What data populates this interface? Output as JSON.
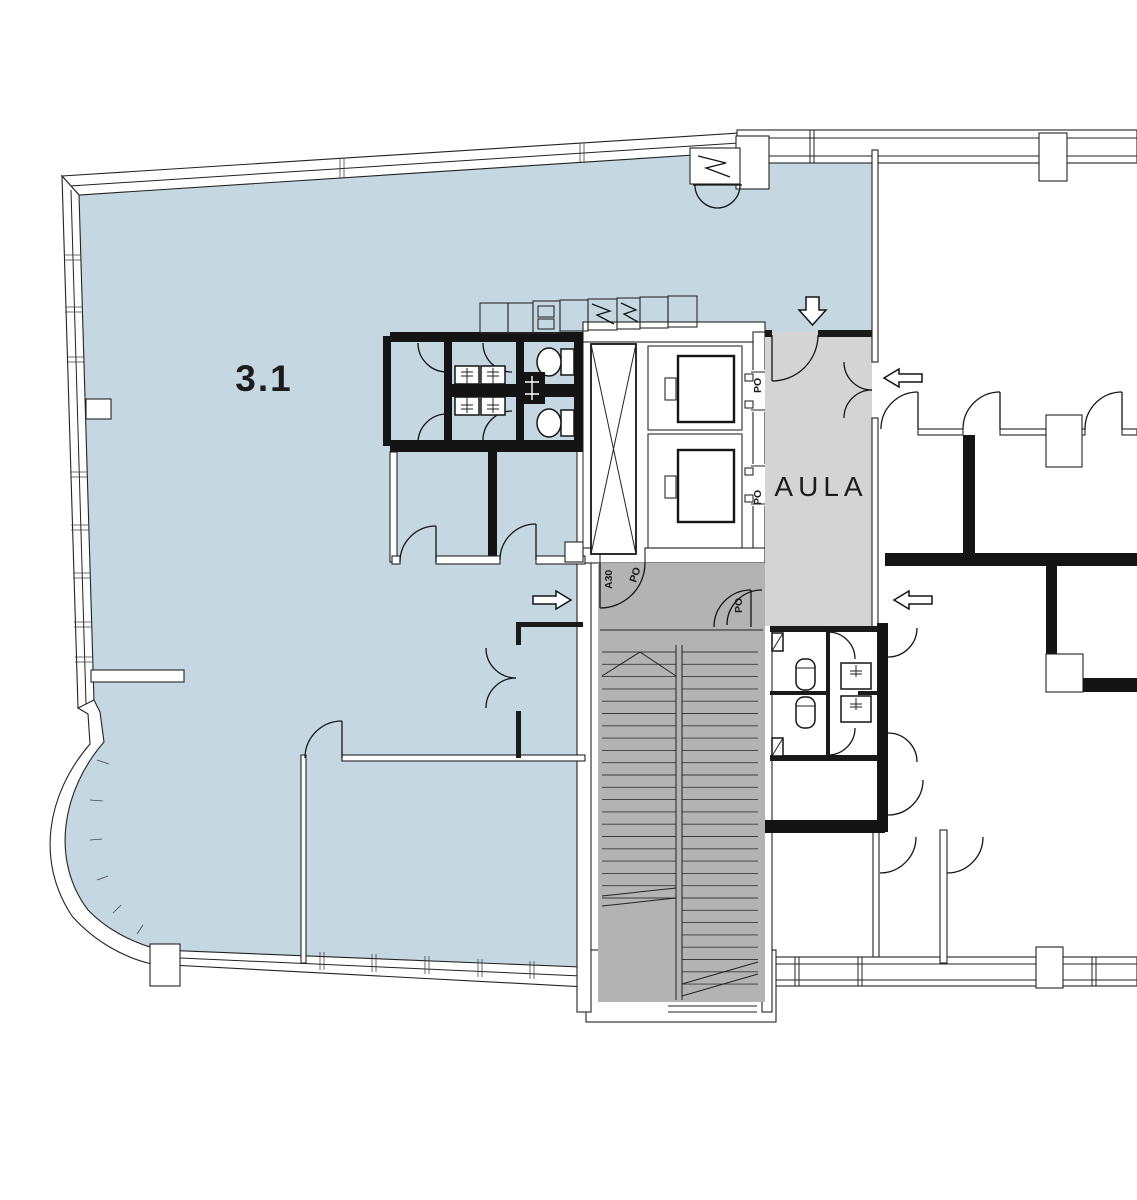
{
  "page": {
    "title": "Floor plan – third floor",
    "background": "#ffffff"
  },
  "plan": {
    "unit_label": "3.1",
    "lobby_label": "AULA",
    "door_rating_po": "PO",
    "door_rating_a30": "A30",
    "colors": {
      "unit_area": "#c5d8e2",
      "lobby_area": "#d4d4d4",
      "stair_area": "#b3b3b3",
      "wall": "#141414",
      "line": "#222222",
      "background": "#ffffff"
    }
  }
}
